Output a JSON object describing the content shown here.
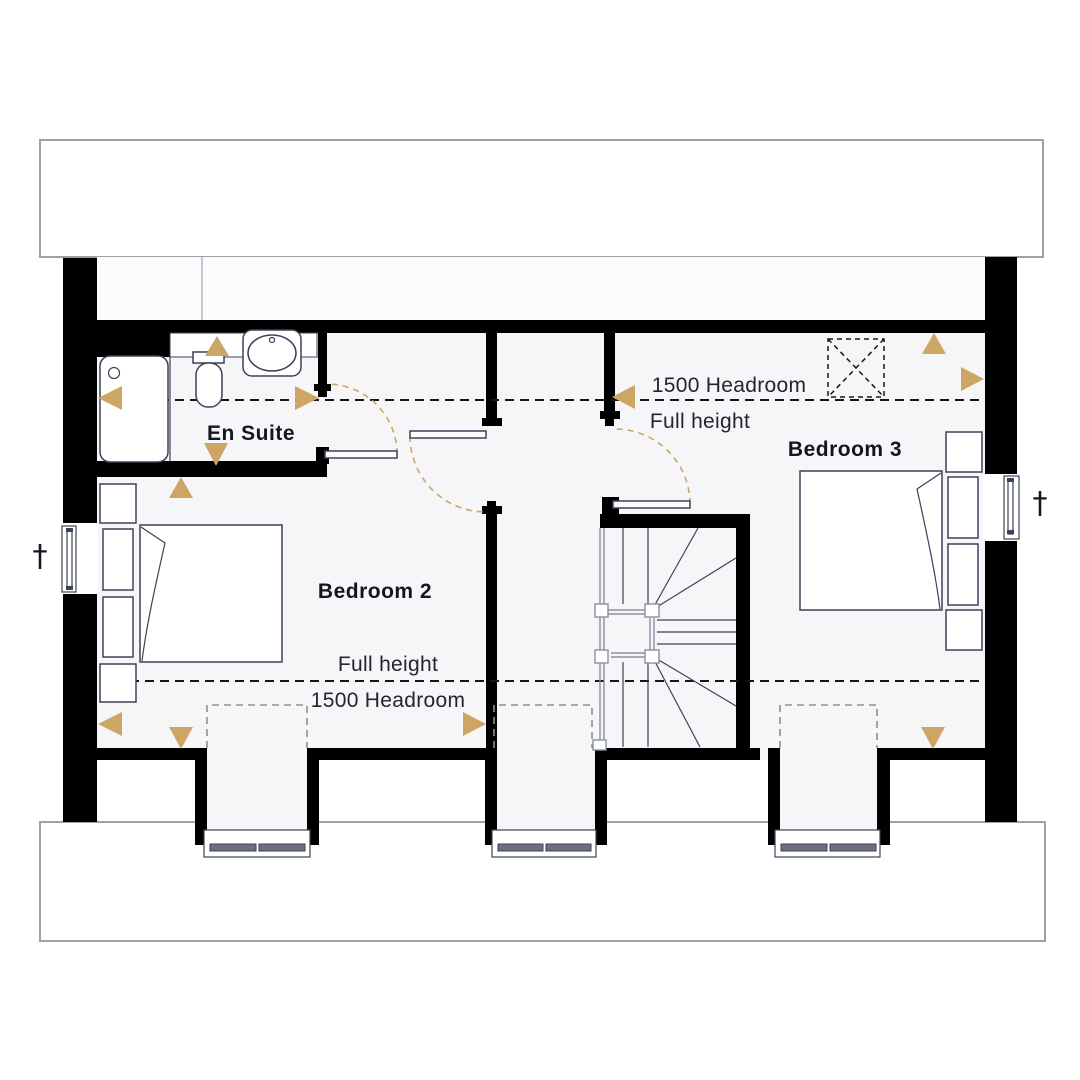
{
  "rooms": {
    "en_suite": "En Suite",
    "bedroom_2": "Bedroom 2",
    "bedroom_3": "Bedroom 3"
  },
  "annotations": {
    "headroom_top": "1500 Headroom",
    "full_height_top": "Full height",
    "full_height_bottom": "Full height",
    "headroom_bottom": "1500 Headroom",
    "dagger_left": "†",
    "dagger_right": "†"
  },
  "colors": {
    "arrow": "#cda666",
    "wall": "#000000",
    "floor": "#f6f6f8",
    "furniture_line": "#3c4257",
    "roof_border": "#9aa0ac"
  }
}
